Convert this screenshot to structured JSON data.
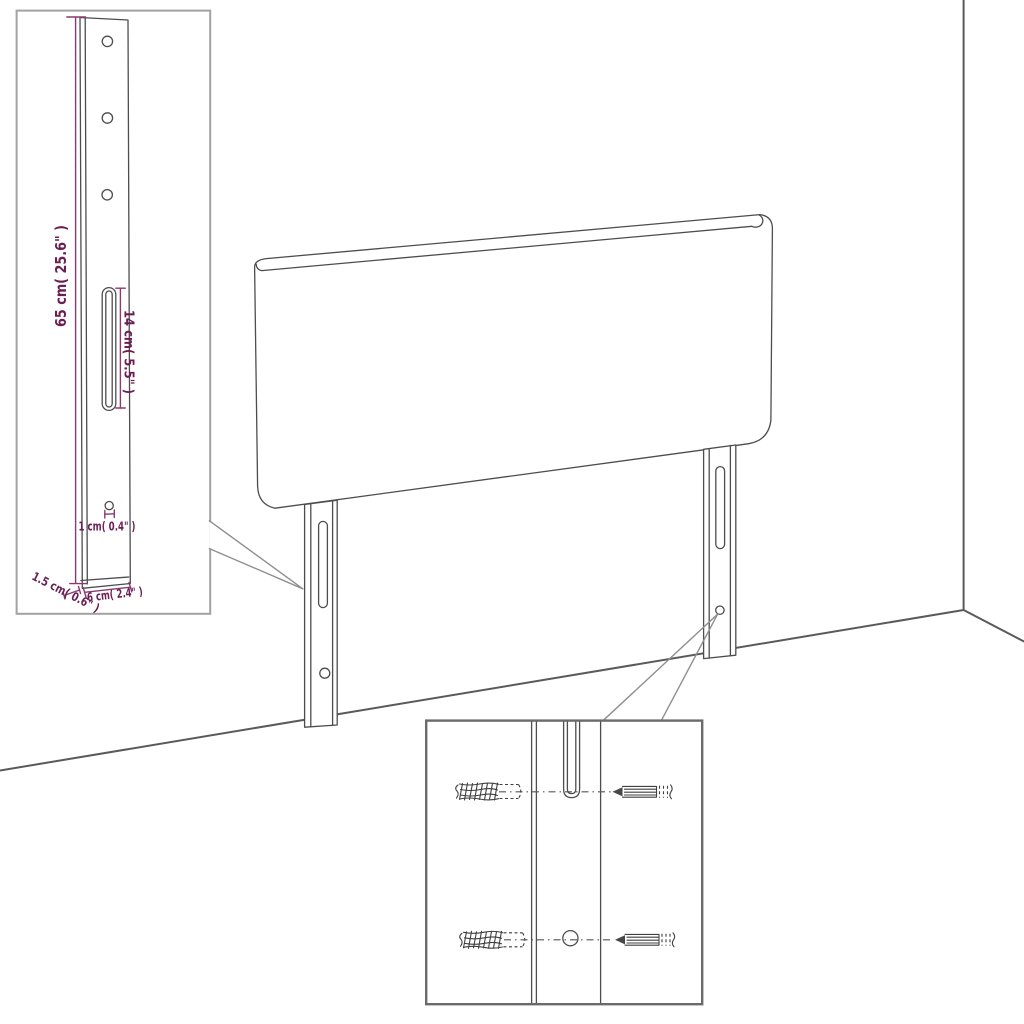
{
  "labels": {
    "leg_height": "65 cm( 25.6\" )",
    "slot_length": "14 cm( 5.5\" )",
    "hole_diameter": "1 cm( 0.4\" )",
    "leg_thickness": "1.5 cm( 0.6\" )",
    "leg_width": "6 cm( 2.4\" )"
  },
  "colors": {
    "background": "#ffffff",
    "drawing_line": "#4d4d4d",
    "wall_line": "#5a5a5a",
    "dimension_line": "#8a3b6d",
    "dimension_text": "#6b1e51",
    "inset_border_light": "#a2a2a2",
    "inset_border_dark": "#6b6b6b"
  }
}
